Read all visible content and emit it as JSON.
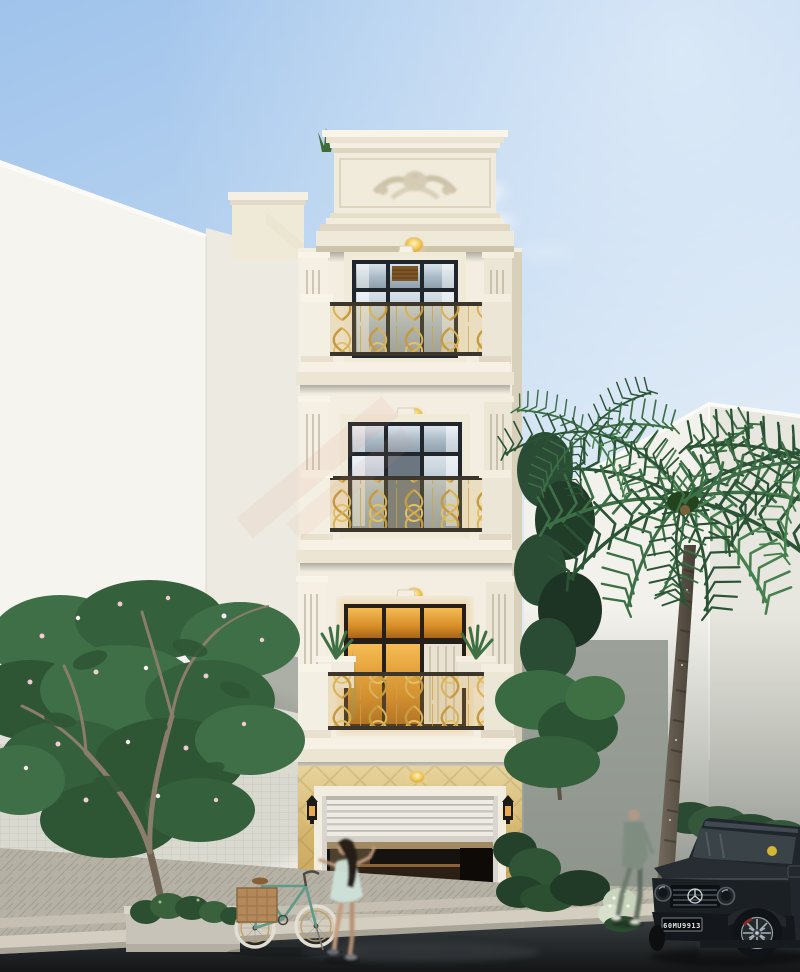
{
  "scene": {
    "kind": "exterior architectural 3D render, street view of a narrow four-storey neoclassical townhouse",
    "sky": {
      "top": "#9fc3eb",
      "mid": "#c8dcf2",
      "horizon": "#eef3f8",
      "cloud": "#ffffff"
    },
    "townhouse": {
      "floors": 4,
      "balconies": 3,
      "style": "neoclassical",
      "facade": "#f3eee1",
      "molding_shadow": "#d9d0bb",
      "frieze_ornament": "floral stucco relief on parapet",
      "railing_gold": "#d2a94e",
      "railing_frame": "#3b352c",
      "window_frame": "#20262b",
      "glass_cool": "#c2cfd9",
      "glass_warm": "#e09b34",
      "ceiling_light": "#f2c149",
      "ceiling_lights_count": 4,
      "stone_cladding": "#d8b86e",
      "garage_shutter": "half-open roller door",
      "shutter_color": "#e9e7e0",
      "wall_lanterns": 2,
      "lantern_color": "#1d1a17",
      "balcony_plants": "spiky green plants in white planters"
    },
    "left_building": {
      "wall": "#f4f2ec",
      "tile_wall": "#eceae2"
    },
    "right_building": {
      "wall_lit": "#f2f1eb",
      "wall_side": "#e7e6df",
      "wall_shaded": "#8d948c"
    },
    "street": {
      "pavement": "#b5b1a4",
      "curb": "#d3cec0",
      "road": "#24282b",
      "driveway": "#c6c1b1"
    },
    "vehicle": {
      "type": "black boxy SUV, front three-quarter view",
      "body": "#1d2226",
      "license_plate": "60MU9913",
      "plate_style": "white on black",
      "windshield_badge": "#e6c233"
    },
    "people": [
      {
        "name": "girl-walking",
        "dress": "#cfe2da",
        "hair": "#241d18"
      },
      {
        "name": "man-walking",
        "outfit": "#7f8d80"
      }
    ],
    "bicycle": {
      "frame": "#5f9b8a",
      "basket": "#b3885a",
      "tires": "#e3ded2"
    },
    "vegetation": {
      "palm_fronds": "#2b5335",
      "palm_trunk": "#5f5749",
      "frangipani_leaves": "#3f6f46",
      "frangipani_flowers": "#f2cdd4",
      "shrubs": "#2c4f31"
    },
    "watermark": {
      "color": "#e2907a",
      "opacity": 0.1
    }
  }
}
